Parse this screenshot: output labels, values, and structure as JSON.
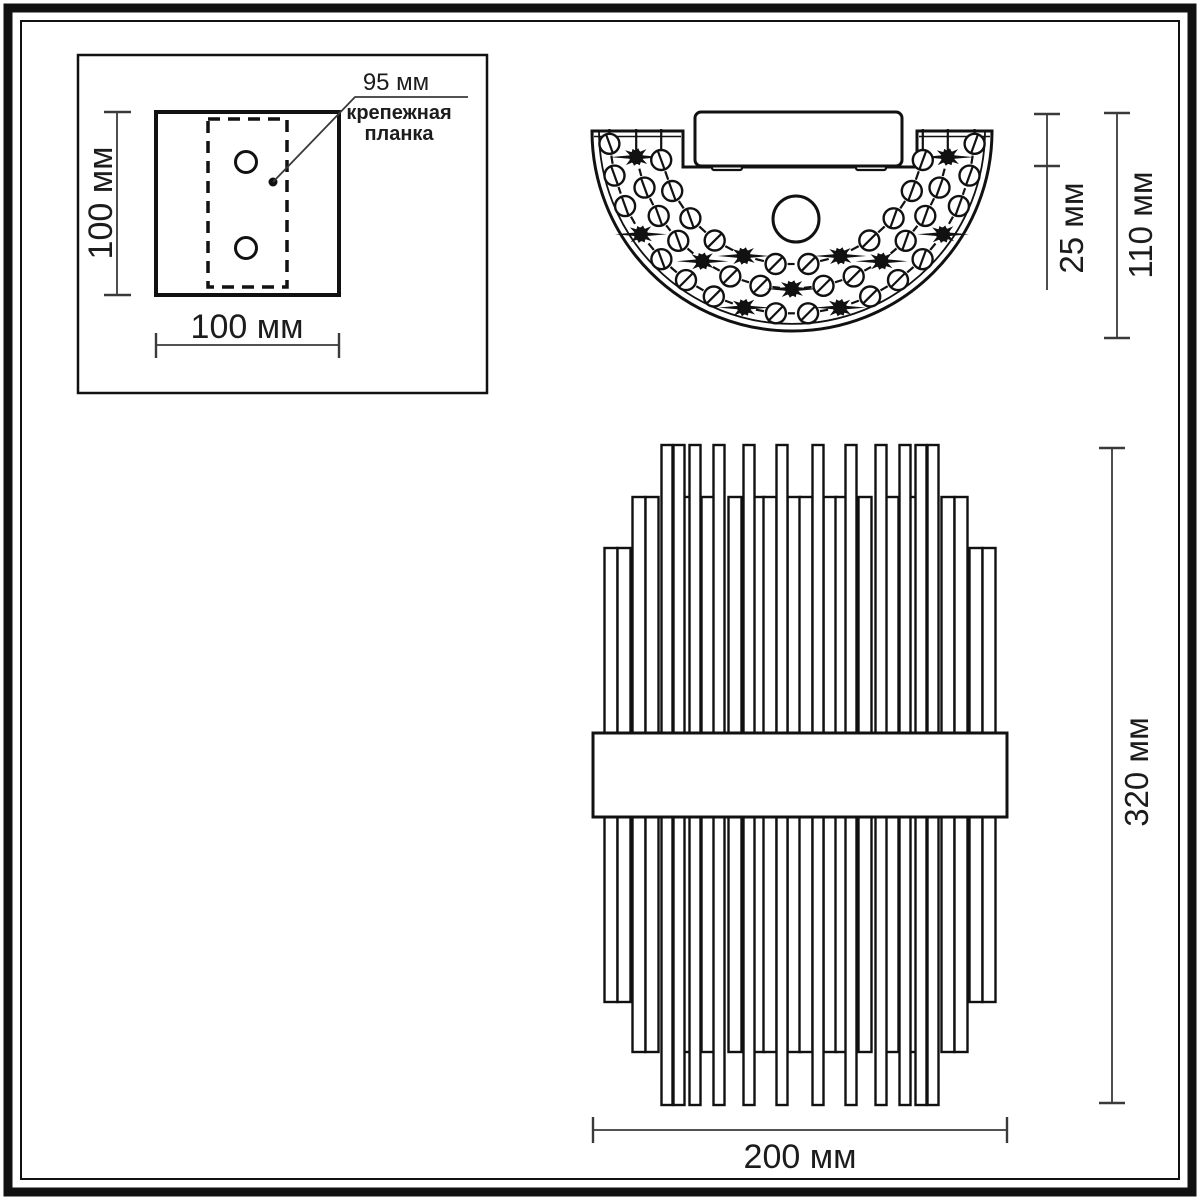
{
  "colors": {
    "ink": "#111111",
    "dimension_line": "#3a3a3a",
    "text": "#1c1c1c",
    "background": "#ffffff"
  },
  "views": {
    "mount_plate": {
      "label_height": "100 мм",
      "label_width": "100 мм",
      "callout_value": "95 мм",
      "callout_label_line1": "крепежная",
      "callout_label_line2": "планка"
    },
    "top_view": {
      "label_box_depth": "25 мм",
      "label_total_depth": "110 мм"
    },
    "front_view": {
      "label_height": "320 мм",
      "label_width": "200 мм"
    }
  }
}
